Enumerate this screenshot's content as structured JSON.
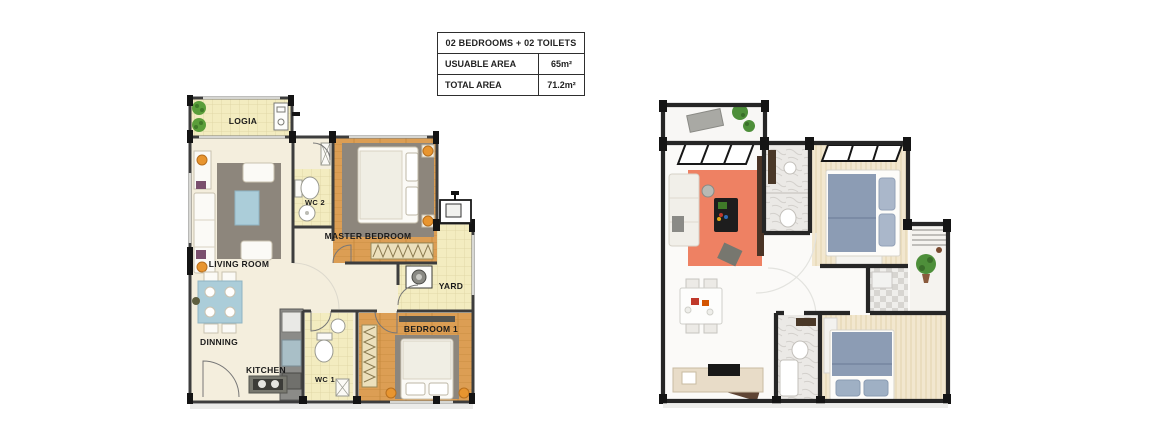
{
  "info_table": {
    "title": "02 BEDROOMS + 02 TOILETS",
    "rows": [
      {
        "label": "USUABLE AREA",
        "value": "65m²"
      },
      {
        "label": "TOTAL AREA",
        "value": "71.2m²"
      }
    ]
  },
  "plan_2d": {
    "labels": {
      "logia": "LOGIA",
      "living_room": "LIVING ROOM",
      "wc2": "WC 2",
      "master_bedroom": "MASTER BEDROOM",
      "yard": "YARD",
      "dinning": "DINNING",
      "kitchen": "KITCHEN",
      "wc1": "WC 1",
      "bedroom1": "BEDROOM 1"
    },
    "colors": {
      "wall": "#3d3d3d",
      "column": "#141414",
      "floor": "#f4eedd",
      "tile": "#f3ecc0",
      "wood": "#dc9e54",
      "rug": "#8d867c",
      "accent_blue": "#abcdd9",
      "accent_orange": "#e8952f",
      "plant": "#5a9e3a"
    }
  },
  "plan_3d": {
    "colors": {
      "wall": "#262626",
      "rug_coral": "#ee8163",
      "bed_blue": "#8c9cb4",
      "wood": "#f2e7cf",
      "marble": "#ebe9e6",
      "plant": "#4e8f3a"
    }
  }
}
